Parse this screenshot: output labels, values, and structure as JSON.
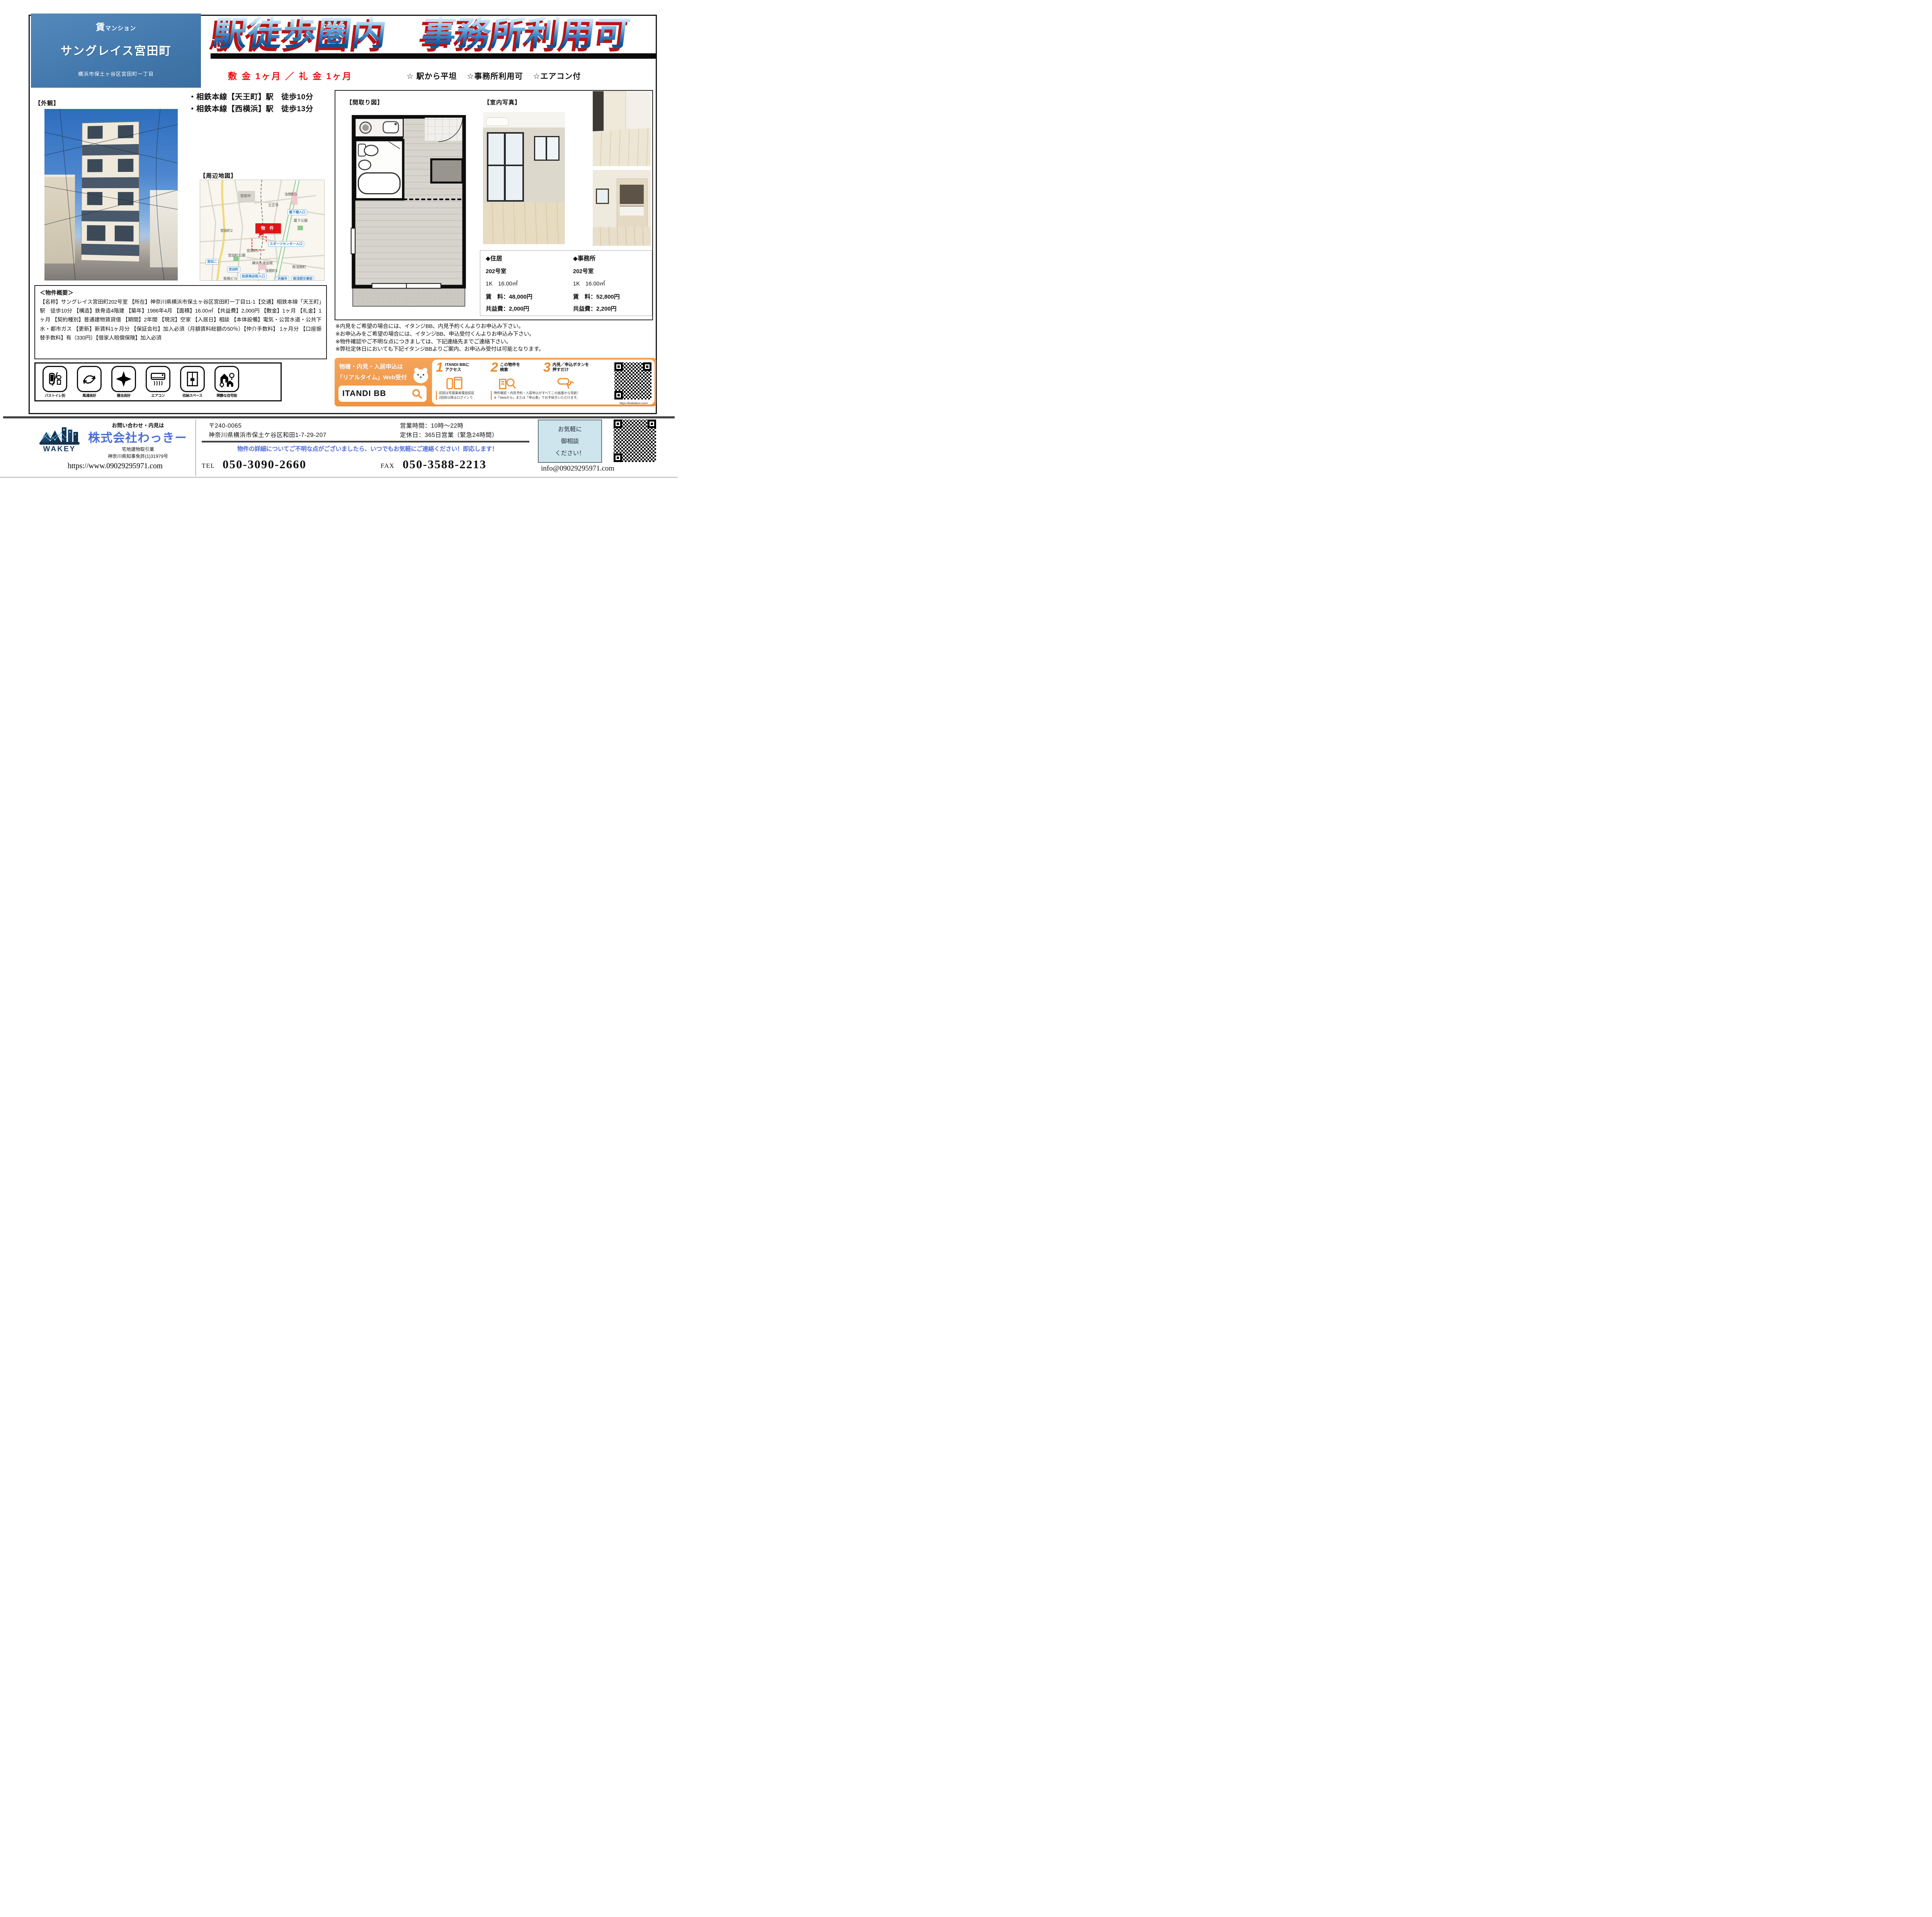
{
  "header": {
    "badge": "賃マンション",
    "name": "サングレイス宮田町",
    "address": "横浜市保土ヶ谷区宮田町一丁目",
    "headline": "駅徒歩圏内　事務所利用可",
    "deposit_line": "敷 金  1ヶ月 ／ 礼 金  1ヶ月",
    "features": [
      "☆ 駅から平坦",
      "☆事務所利用可",
      "☆エアコン付"
    ],
    "accent_blue": "#4379ad",
    "accent_red": "#e81010"
  },
  "access": {
    "line1": "・相鉄本線【天王町】駅　徒歩10分",
    "line2": "・相鉄本線【西横浜】駅　徒歩13分"
  },
  "labels": {
    "exterior": "【外観】",
    "map": "【周辺地図】",
    "floorplan": "【間取り図】",
    "photos": "【室内写真】"
  },
  "map": {
    "labels": [
      "宮田中",
      "浅間町3",
      "立正寺",
      "霜下橋入口",
      "霜下公園",
      "宮田町2",
      "物 件",
      "スポーツセンター入口",
      "宮田町1",
      "宮田町公園",
      "宮田二",
      "横浜水道会館",
      "宮田町",
      "浅間町5",
      "南浅間町",
      "松原商店街入口",
      "洪福寺",
      "南浅間交番前",
      "板橋ビル"
    ]
  },
  "overview": {
    "title": "＜物件概要＞",
    "body": "【名称】サングレイス宮田町202号室 【所在】神奈川県横浜市保土ヶ谷区宮田町一丁目11-1【交通】相鉄本線「天王町」駅　徒歩10分 【構造】鉄骨造4階建 【築年】1986年4月 【面積】16.00㎡ 【共益費】2,000円 【敷金】1ヶ月 【礼金】1ヶ月 【契約種別】普通建物賃貸借 【期間】2年間 【現況】空家 【入居日】相談 【本体設備】電気・公営水道・公共下水・都市ガス 【更新】新賃料1ヶ月分 【保証会社】加入必須（月額賃料総額の50％）【仲介手数料】 1ヶ月分 【口座振替手数料】有（330円）【借家人賠償保険】加入必須"
  },
  "amenities": [
    {
      "label": "バストイレ別"
    },
    {
      "label": "風通良好"
    },
    {
      "label": "陽当良好"
    },
    {
      "label": "エアコン"
    },
    {
      "label": "収納スペース"
    },
    {
      "label": "閑静な住宅街"
    }
  ],
  "units": [
    {
      "category": "◆住居",
      "room": "202号室",
      "plan": "1K　16.00㎡",
      "rent_label": "賃　料：",
      "rent": "48,000円",
      "fee_label": "共益費：",
      "fee": "2,000円"
    },
    {
      "category": "◆事務所",
      "room": "202号室",
      "plan": "1K　16.00㎡",
      "rent_label": "賃　料：",
      "rent": "52,800円",
      "fee_label": "共益費：",
      "fee": "2,200円"
    }
  ],
  "notes": [
    "※内見をご希望の場合には、イタンジBB、内見予約くんよりお申込み下さい。",
    "※お申込みをご希望の場合には、イタンジBB、申込受付くんよりお申込み下さい。",
    "※物件確認やご不明な点につきましては、下記連絡先までご連絡下さい。",
    "※弊社定休日においても下記イタンジBBよりご案内、お申込み受付は可能となります。"
  ],
  "itandi": {
    "lead1": "物確・内見・入居申込は",
    "lead2": "「リアルタイム」Web受付",
    "logo": "ITANDI BB",
    "steps": [
      {
        "num": "1",
        "l1": "ITANDI BBに",
        "l2": "アクセス"
      },
      {
        "num": "2",
        "l1": "この物件を",
        "l2": "検索"
      },
      {
        "num": "3",
        "l1": "内見／申込ボタンを",
        "l2": "押すだけ"
      }
    ],
    "fp1a": "初回は宅建業者電話認証",
    "fp1b": "2回目以降はログインで",
    "fp2a": "物件確認・内見予約・入居申込がすべてこの画面から完結！",
    "fp2b": "※「Webから」または「申込書」でお手続きいただけます。",
    "qr_caption": "https://bukkakun.com/",
    "accent_orange": "#ef9440"
  },
  "footer": {
    "lead": "お問い合わせ・内見は",
    "company": "株式会社わっきー",
    "logo_text": "WAKEY",
    "biz": "宅地建物取引業",
    "license": "神奈川県知事免許(1)31979号",
    "url": "https://www.09029295971.com",
    "postal": "〒240-0065",
    "address": "神奈川県横浜市保土ケ谷区和田1-7-29-207",
    "hours": "営業時間：10時～22時",
    "holiday": "定休日：365日営業（緊急24時間）",
    "message": "物件の詳細についてご不明な点がございましたら、いつでもお気軽にご連絡ください！即応します！",
    "tel_label": "TEL",
    "tel": "050-3090-2660",
    "fax_label": "FAX",
    "fax": "050-3588-2213",
    "consult": [
      "お気軽に",
      "御相談",
      "ください！"
    ],
    "email": "info@09029295971.com"
  }
}
